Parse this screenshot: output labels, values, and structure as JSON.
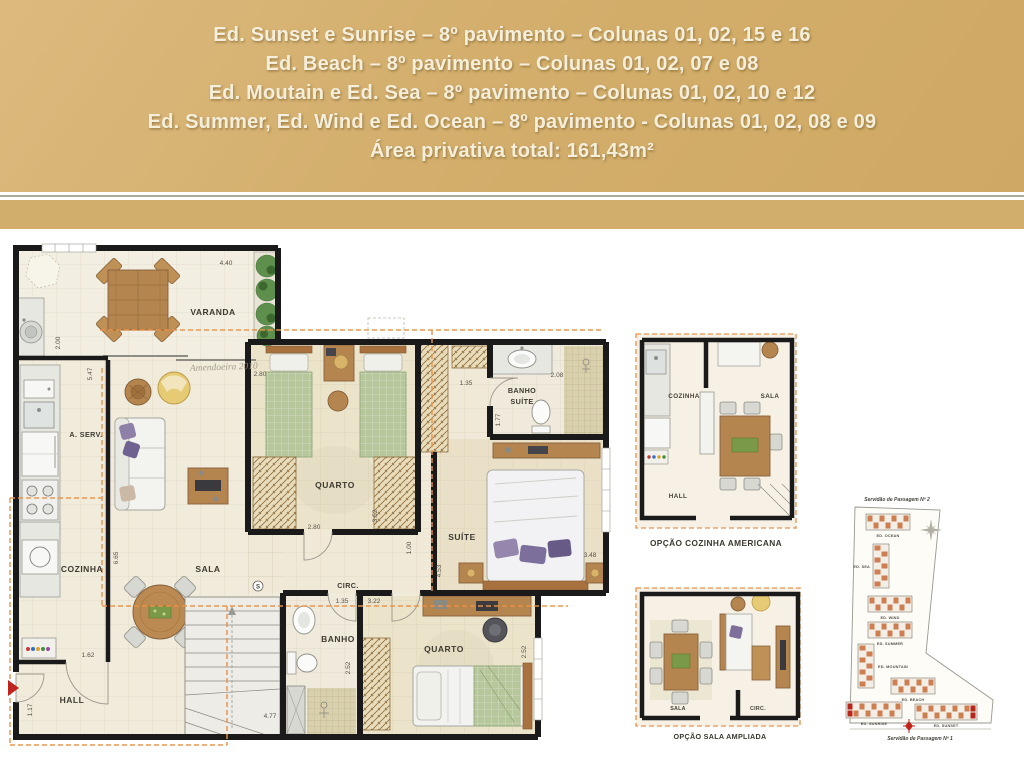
{
  "header": {
    "bg": "#d2ae6c",
    "text_color": "#f4eedb",
    "divider_color": "#a9ae9b",
    "lines": [
      "Ed. Sunset e  Sunrise – 8º pavimento – Colunas  01, 02, 15 e 16",
      "Ed. Beach – 8º pavimento – Colunas  01, 02, 07 e 08",
      "Ed. Moutain e Ed. Sea – 8º pavimento – Colunas  01, 02, 10 e 12",
      "Ed. Summer, Ed. Wind  e Ed. Ocean – 8º pavimento  - Colunas 01, 02, 08 e 09",
      "Área privativa total: 161,43m²"
    ]
  },
  "main_plan": {
    "rooms": {
      "varanda": "VARANDA",
      "a_serv": "A. SERV.",
      "cozinha": "COZINHA",
      "sala": "SALA",
      "hall": "HALL",
      "quarto_top": "QUARTO",
      "circ": "CIRC.",
      "banho": "BANHO",
      "suite": "SUÍTE",
      "banho_suite_l1": "BANHO",
      "banho_suite_l2": "SUÍTE",
      "quarto_bottom": "QUARTO"
    },
    "dims": {
      "varanda_w": "4.40",
      "varanda_d": "2.00",
      "cozinha_len": "5.47",
      "quarto_top_w": "2.80",
      "corridor_w": "1.35",
      "banho_suite_w": "2.08",
      "banho_suite_d": "1.77",
      "quarto_w": "2.80",
      "quarto_d": "3.52",
      "circ_w": "1.00",
      "suite_d": "4.53",
      "suite_w": "3.48",
      "banho_door": "1.35",
      "quarto2_door": "3.22",
      "quarto2_d": "2.52",
      "quarto2_w": "2.52",
      "sala_len": "6.65",
      "cozinha_door": "1.62",
      "hall_w": "1.17",
      "stairs_run": "4.77"
    },
    "section_marker": "S",
    "watermark": "Amendoeira 2010"
  },
  "options": [
    {
      "caption": "OPÇÃO COZINHA AMERICANA",
      "rooms": {
        "cozinha": "COZINHA",
        "sala": "SALA",
        "hall": "HALL"
      }
    },
    {
      "caption": "OPÇÃO SALA AMPLIADA",
      "rooms": {
        "sala": "SALA",
        "circ": "CIRC."
      }
    }
  ],
  "site_map": {
    "road_top": "Servidão de Passagem Nº 2",
    "road_bottom": "Servidão de Passagem Nº 1",
    "accent": "#cd7f52",
    "highlight": "#b8271b",
    "buildings": [
      {
        "name": "ED. OCEAN"
      },
      {
        "name": "ED. SEA"
      },
      {
        "name": "ED. WIND"
      },
      {
        "name": "ED. SUMMER"
      },
      {
        "name": "ED. MOUNTAIN"
      },
      {
        "name": "ED. BEACH"
      },
      {
        "name": "ED. SUNRISE"
      },
      {
        "name": "ED. SUNSET"
      }
    ]
  }
}
